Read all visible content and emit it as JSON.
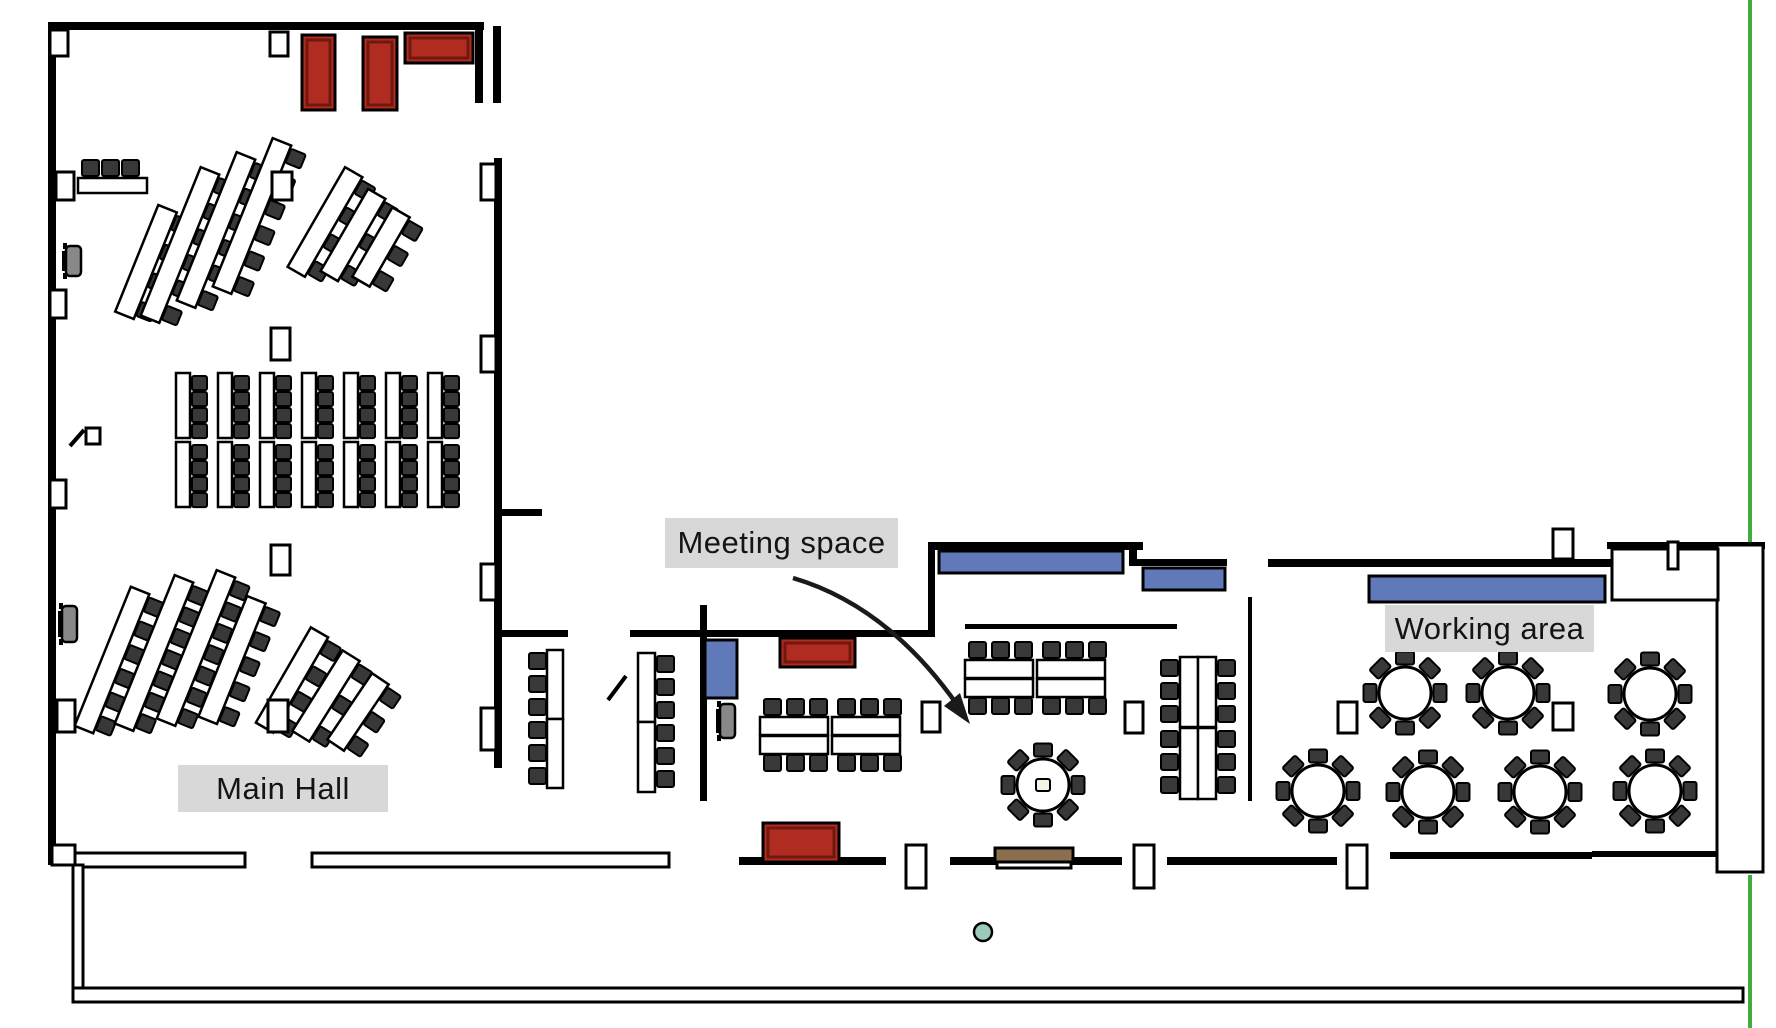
{
  "labels": {
    "main_hall": "Main Hall",
    "meeting_space": "Meeting space",
    "working_area": "Working area"
  },
  "label_boxes": {
    "main_hall": {
      "x": 178,
      "y": 765,
      "w": 210,
      "h": 47
    },
    "meeting_space": {
      "x": 665,
      "y": 518,
      "w": 233,
      "h": 50
    },
    "working_area": {
      "x": 1385,
      "y": 605,
      "w": 209,
      "h": 47
    }
  },
  "colors": {
    "wall": "#000000",
    "red": "#b02c20",
    "red_inner": "#701810",
    "blue": "#6079b8",
    "brown": "#8a6f4f",
    "chair": "#383838",
    "table": "#ffffff",
    "green_line": "#3fae3f",
    "teal": "#9ccbbb",
    "label_bg": "#d8d8d8",
    "podium": "#888888"
  },
  "floorplan": {
    "green": {
      "x": 1748,
      "w": 4,
      "segs": [
        [
          0,
          543
        ],
        [
          875,
          1028
        ]
      ]
    },
    "bars": [
      [
        48,
        22,
        436,
        8
      ],
      [
        475,
        30,
        8,
        73
      ],
      [
        493,
        26,
        8,
        77
      ],
      [
        48,
        22,
        8,
        843
      ],
      [
        494,
        158,
        8,
        610
      ],
      [
        502,
        509,
        40,
        7
      ],
      [
        502,
        630,
        66,
        7
      ],
      [
        630,
        630,
        76,
        7
      ],
      [
        700,
        605,
        7,
        196
      ],
      [
        707,
        630,
        223,
        7
      ],
      [
        928,
        548,
        7,
        89
      ],
      [
        928,
        542,
        215,
        8
      ],
      [
        1129,
        548,
        8,
        18
      ],
      [
        1131,
        559,
        96,
        7
      ],
      [
        965,
        624,
        212,
        5
      ],
      [
        1248,
        597,
        4,
        204
      ],
      [
        1268,
        559,
        347,
        8
      ],
      [
        1607,
        542,
        158,
        7
      ],
      [
        739,
        857,
        147,
        8
      ],
      [
        950,
        857,
        172,
        8
      ],
      [
        1167,
        857,
        170,
        8
      ],
      [
        1390,
        852,
        202,
        7
      ],
      [
        1592,
        851,
        126,
        6
      ],
      [
        1660,
        591,
        16,
        10
      ]
    ],
    "wrects": [
      [
        75,
        853,
        170,
        14
      ],
      [
        312,
        853,
        357,
        14
      ],
      [
        73,
        865,
        10,
        130
      ],
      [
        73,
        988,
        1670,
        14
      ],
      [
        1717,
        545,
        46,
        327
      ],
      [
        1612,
        549,
        106,
        51
      ],
      [
        1668,
        542,
        10,
        27
      ],
      [
        1553,
        529,
        20,
        30
      ],
      [
        52,
        845,
        23,
        20
      ],
      [
        50,
        30,
        18,
        26
      ],
      [
        270,
        32,
        18,
        24
      ],
      [
        56,
        172,
        18,
        28
      ],
      [
        50,
        290,
        16,
        28
      ],
      [
        50,
        480,
        16,
        28
      ],
      [
        57,
        700,
        18,
        32
      ],
      [
        272,
        172,
        20,
        28
      ],
      [
        271,
        328,
        19,
        32
      ],
      [
        271,
        545,
        19,
        30
      ],
      [
        268,
        700,
        20,
        32
      ],
      [
        922,
        702,
        18,
        30
      ],
      [
        1125,
        702,
        18,
        31
      ],
      [
        1338,
        702,
        19,
        31
      ],
      [
        1553,
        703,
        20,
        27
      ],
      [
        906,
        845,
        20,
        43
      ],
      [
        1134,
        845,
        20,
        43
      ],
      [
        1347,
        845,
        20,
        43
      ],
      [
        481,
        164,
        15,
        36
      ],
      [
        481,
        336,
        15,
        36
      ],
      [
        481,
        564,
        15,
        36
      ],
      [
        481,
        708,
        15,
        42
      ],
      [
        86,
        428,
        14,
        16
      ],
      [
        997,
        862,
        74,
        6
      ]
    ],
    "lines": [
      [
        70,
        446,
        84,
        430,
        4
      ],
      [
        608,
        700,
        626,
        676,
        4
      ]
    ],
    "colored": [
      {
        "x": 302,
        "y": 35,
        "w": 33,
        "h": 75,
        "c": "red"
      },
      {
        "x": 363,
        "y": 37,
        "w": 34,
        "h": 73,
        "c": "red"
      },
      {
        "x": 405,
        "y": 33,
        "w": 68,
        "h": 30,
        "c": "red"
      },
      {
        "x": 780,
        "y": 638,
        "w": 75,
        "h": 29,
        "c": "red"
      },
      {
        "x": 763,
        "y": 823,
        "w": 76,
        "h": 39,
        "c": "red"
      },
      {
        "x": 939,
        "y": 551,
        "w": 184,
        "h": 22,
        "c": "blue"
      },
      {
        "x": 1143,
        "y": 568,
        "w": 82,
        "h": 22,
        "c": "blue"
      },
      {
        "x": 1369,
        "y": 576,
        "w": 236,
        "h": 26,
        "c": "blue"
      },
      {
        "x": 705,
        "y": 640,
        "w": 32,
        "h": 58,
        "c": "blue"
      },
      {
        "x": 995,
        "y": 848,
        "w": 78,
        "h": 14,
        "c": "brown"
      }
    ],
    "teal": {
      "cx": 983,
      "cy": 932,
      "r": 9
    },
    "fans": [
      {
        "cx": 146,
        "cy": 262,
        "len": 115,
        "n": 4,
        "ang": 22
      },
      {
        "cx": 180,
        "cy": 245,
        "len": 160,
        "n": 6,
        "ang": 22
      },
      {
        "cx": 216,
        "cy": 230,
        "len": 160,
        "n": 6,
        "ang": 22
      },
      {
        "cx": 252,
        "cy": 216,
        "len": 160,
        "n": 6,
        "ang": 22
      },
      {
        "cx": 325,
        "cy": 222,
        "len": 115,
        "n": 4,
        "ang": 30
      },
      {
        "cx": 353,
        "cy": 235,
        "len": 95,
        "n": 3,
        "ang": 30
      },
      {
        "cx": 381,
        "cy": 247,
        "len": 80,
        "n": 3,
        "ang": 30
      },
      {
        "cx": 112,
        "cy": 660,
        "len": 150,
        "n": 6,
        "ang": 22
      },
      {
        "cx": 154,
        "cy": 653,
        "len": 160,
        "n": 7,
        "ang": 22
      },
      {
        "cx": 196,
        "cy": 648,
        "len": 160,
        "n": 7,
        "ang": 22
      },
      {
        "cx": 232,
        "cy": 660,
        "len": 130,
        "n": 5,
        "ang": 22
      },
      {
        "cx": 292,
        "cy": 680,
        "len": 110,
        "n": 4,
        "ang": 30
      },
      {
        "cx": 326,
        "cy": 696,
        "len": 95,
        "n": 3,
        "ang": 32
      },
      {
        "cx": 358,
        "cy": 712,
        "len": 80,
        "n": 3,
        "ang": 34
      }
    ],
    "straight": {
      "x0": 176,
      "dx": 42,
      "cols": 7,
      "tw": 14,
      "rows": [
        373,
        442
      ],
      "th": 65,
      "chairDx": 16,
      "cs": 15,
      "chairOff": [
        3,
        19,
        35,
        51
      ]
    },
    "regtable": {
      "table": [
        78,
        178,
        69,
        15
      ],
      "chairs": [
        [
          82,
          160
        ],
        [
          102,
          160
        ],
        [
          122,
          160
        ]
      ],
      "cs": 17
    },
    "vpairs": [
      {
        "tables": [
          [
            547,
            650,
            16,
            69
          ],
          [
            547,
            719,
            16,
            69
          ]
        ],
        "chairX": 529,
        "chairYs": [
          653,
          676,
          699,
          722,
          745,
          768
        ],
        "cs": 17
      },
      {
        "tables": [
          [
            638,
            653,
            17,
            69
          ],
          [
            638,
            722,
            17,
            70
          ]
        ],
        "chairX": 657,
        "chairYs": [
          656,
          679,
          702,
          725,
          748,
          771
        ],
        "cs": 17
      }
    ],
    "hblocks": [
      {
        "tables": [
          [
            760,
            717
          ],
          [
            832,
            717
          ],
          [
            760,
            736
          ],
          [
            832,
            736
          ]
        ],
        "tw": 68,
        "th": 18,
        "chairXs": [
          764,
          787,
          810,
          838,
          861,
          884
        ],
        "rows": [
          699,
          755
        ],
        "cs": 17
      },
      {
        "tables": [
          [
            965,
            660
          ],
          [
            1037,
            660
          ],
          [
            965,
            679
          ],
          [
            1037,
            679
          ]
        ],
        "tw": 68,
        "th": 18,
        "chairXs": [
          969,
          992,
          1015,
          1043,
          1066,
          1089
        ],
        "rows": [
          642,
          698
        ],
        "cs": 17
      }
    ],
    "dblcols": [
      {
        "tables": [
          [
            1180,
            657,
            18,
            70
          ],
          [
            1198,
            657,
            18,
            70
          ],
          [
            1180,
            728,
            18,
            71
          ],
          [
            1198,
            728,
            18,
            71
          ]
        ],
        "chairXs": [
          1161,
          1218
        ],
        "chairYs": [
          660,
          683,
          706,
          731,
          754,
          777
        ],
        "cs": 17
      }
    ],
    "rounds": {
      "r": 26,
      "chairR": 35,
      "cw": 18,
      "ch": 13,
      "items": [
        [
          1043,
          785,
          1
        ],
        [
          1405,
          693,
          0
        ],
        [
          1508,
          693,
          0
        ],
        [
          1650,
          694,
          0
        ],
        [
          1318,
          791,
          0
        ],
        [
          1428,
          792,
          0
        ],
        [
          1540,
          792,
          0
        ],
        [
          1655,
          791,
          0
        ]
      ]
    },
    "podiums": [
      [
        62,
        246,
        30
      ],
      [
        58,
        606,
        36
      ],
      [
        716,
        704,
        34
      ]
    ],
    "arrow": {
      "path": "M793,578 Q888,606 958,706",
      "head": "970,724 944,706 960,693"
    }
  }
}
